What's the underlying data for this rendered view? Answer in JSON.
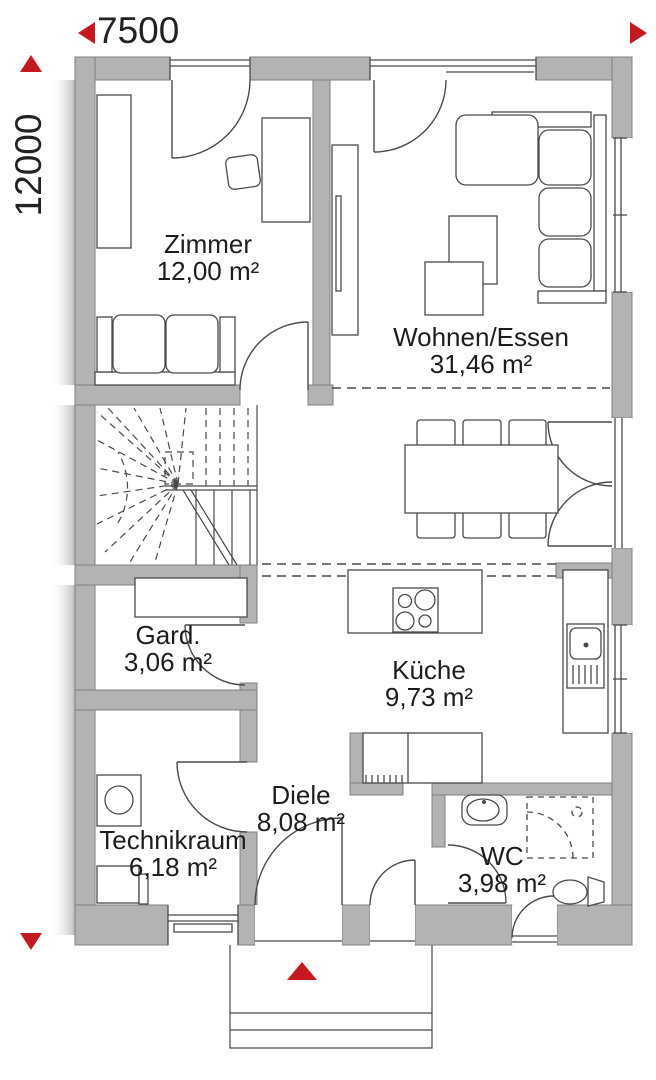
{
  "dimensions": {
    "top": "7500",
    "left": "12000"
  },
  "rooms": [
    {
      "id": "zimmer",
      "name": "Zimmer",
      "area": "12,00 m²"
    },
    {
      "id": "wohnen",
      "name": "Wohnen/Essen",
      "area": "31,46 m²"
    },
    {
      "id": "gard",
      "name": "Gard.",
      "area": "3,06 m²"
    },
    {
      "id": "kueche",
      "name": "Küche",
      "area": "9,73 m²"
    },
    {
      "id": "diele",
      "name": "Diele",
      "area": "8,08 m²"
    },
    {
      "id": "technikraum",
      "name": "Technikraum",
      "area": "6,18 m²"
    },
    {
      "id": "wc",
      "name": "WC",
      "area": "3,98 m²"
    }
  ],
  "colors": {
    "wall": "#b3b3b3",
    "wall_edge": "#7f7f7f",
    "line": "#4a4a4a",
    "accent_red": "#c41a1f",
    "text": "#1d1d1d"
  },
  "icons": [
    "up-arrow-icon",
    "down-arrow-icon",
    "left-arrow-icon",
    "right-arrow-icon",
    "entrance-arrow-icon",
    "bed-sofa-icon",
    "desk-icon",
    "chair-icon",
    "wardrobe-icon",
    "sideboard-icon",
    "corner-sofa-icon",
    "coffee-table-icon",
    "dining-table-icon",
    "dining-chair-icon",
    "winder-staircase-icon",
    "cooktop-icon",
    "kitchen-sink-icon",
    "kitchen-counter-icon",
    "washing-machine-icon",
    "washbasin-icon",
    "shower-icon",
    "toilet-icon",
    "door-swing-icon",
    "window-icon",
    "porch-steps-icon"
  ]
}
